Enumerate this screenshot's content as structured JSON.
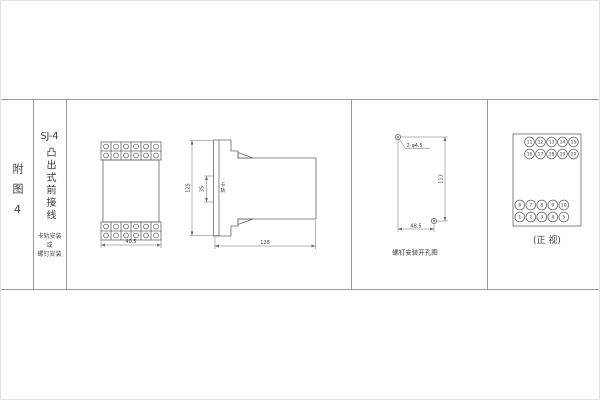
{
  "sheet": {
    "background": "#ffffff",
    "table_rule_color": "#9a9a9a",
    "drawing_line_color": "#666666"
  },
  "index_column": {
    "label": "附图4"
  },
  "title_column": {
    "model": "SJ-4",
    "title_vertical": "凸出式前接线",
    "mount_note_lines": [
      "卡轨安装",
      "或",
      "螺钉安装"
    ]
  },
  "front_view": {
    "width_dim": "40.5",
    "terminal_blocks": 2,
    "terminal_rows_per_block": 2,
    "terminal_cols": 6
  },
  "side_view": {
    "height_dim": "125",
    "rail_dim": "35",
    "rail_label": "卡轨",
    "length_dim": "128"
  },
  "hole_diagram": {
    "hole_label": "2-φ4.5",
    "vertical_dim": "113",
    "horizontal_dim": "48.5",
    "caption": "螺钉安装开孔图"
  },
  "terminal_view": {
    "caption": "(正 视)",
    "top_rows": [
      [
        "11",
        "12",
        "13",
        "14",
        "15"
      ],
      [
        "16",
        "17",
        "18",
        "19",
        "20"
      ]
    ],
    "bottom_rows": [
      [
        "6",
        "7",
        "8",
        "9",
        "10"
      ],
      [
        "1",
        "2",
        "3",
        "4",
        "5"
      ]
    ]
  }
}
